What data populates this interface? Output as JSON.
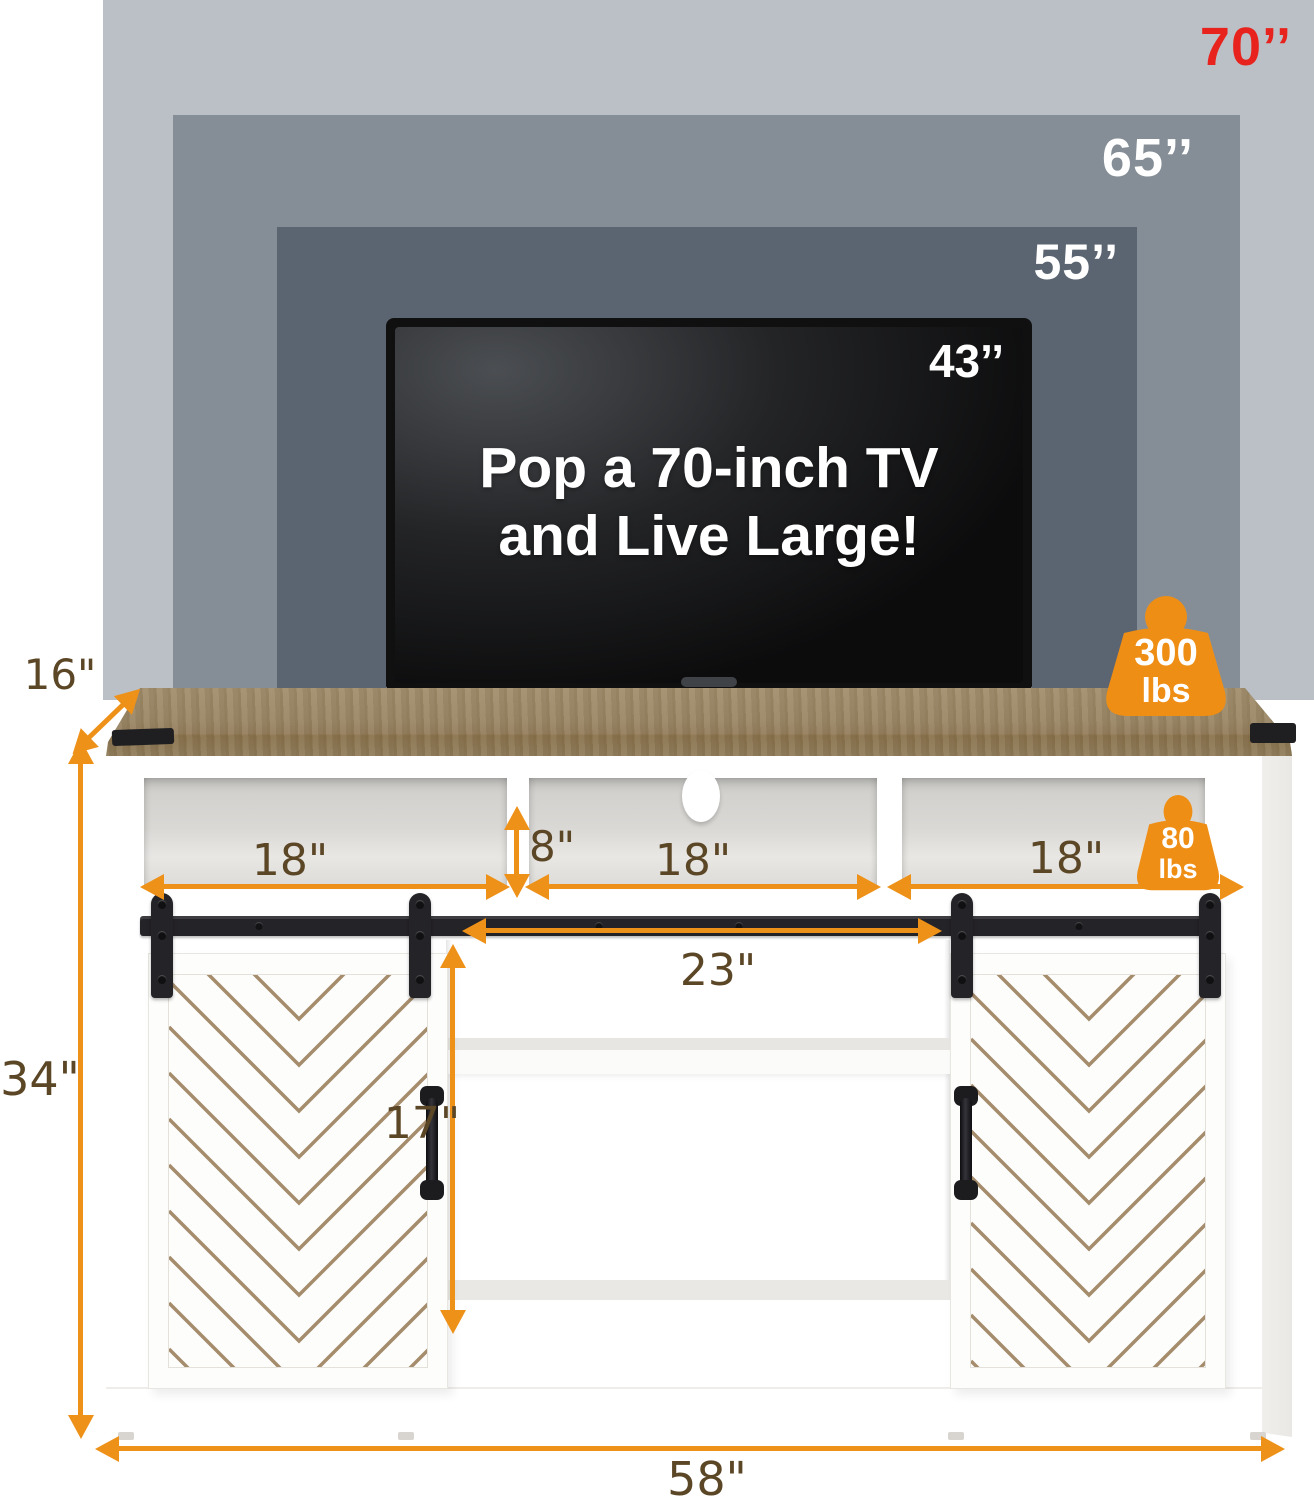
{
  "backdrop": {
    "sizes": [
      {
        "label": "70’’",
        "color": "#e8231d",
        "panel_color": "#bac0c6"
      },
      {
        "label": "65’’",
        "color": "#ffffff",
        "panel_color": "#858e96"
      },
      {
        "label": "55’’",
        "color": "#ffffff",
        "panel_color": "#5b6571"
      }
    ]
  },
  "tv": {
    "size_label": "43’’",
    "headline_line1": "Pop a 70-inch TV",
    "headline_line2": "and Live Large!"
  },
  "capacities": {
    "tabletop": {
      "value": "300",
      "unit": "lbs"
    },
    "cubby": {
      "value": "80",
      "unit": "lbs"
    }
  },
  "dimensions": {
    "depth": "16\"",
    "height": "34\"",
    "width": "58\"",
    "cubby_left_width": "18\"",
    "cubby_opening_height": "8\"",
    "cubby_middle_width": "18\"",
    "cubby_right_width": "18\"",
    "sliding_rail_width": "23\"",
    "door_height": "17\""
  },
  "colors": {
    "accent_orange": "#ee9119",
    "highlight_red": "#e8231d",
    "dimension_text": "#5b4626",
    "wood_top": "#9a8766",
    "chevron_line": "#a58c6c",
    "hardware_black": "#242327"
  }
}
